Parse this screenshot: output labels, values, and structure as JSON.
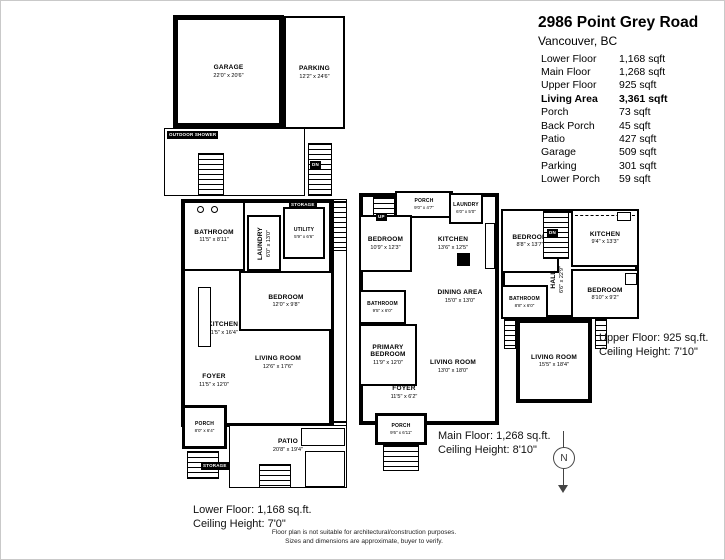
{
  "header": {
    "title": "2986 Point Grey Road",
    "subtitle": "Vancouver, BC"
  },
  "area_table": {
    "rows": [
      {
        "label": "Lower Floor",
        "value": "1,168 sqft"
      },
      {
        "label": "Main Floor",
        "value": "1,268 sqft"
      },
      {
        "label": "Upper Floor",
        "value": "925 sqft"
      },
      {
        "label": "Living Area",
        "value": "3,361 sqft"
      },
      {
        "label": "Porch",
        "value": "73 sqft"
      },
      {
        "label": "Back Porch",
        "value": "45 sqft"
      },
      {
        "label": "Patio",
        "value": "427 sqft"
      },
      {
        "label": "Garage",
        "value": "509 sqft"
      },
      {
        "label": "Parking",
        "value": "301 sqft"
      },
      {
        "label": "Lower Porch",
        "value": "59 sqft"
      }
    ]
  },
  "plans": {
    "lower": {
      "caption": {
        "line1": "Lower Floor: 1,168 sq.ft.",
        "line2": "Ceiling Height: 7'0\""
      },
      "rooms": {
        "garage": {
          "name": "GARAGE",
          "dims": "22'0\" x 20'6\""
        },
        "parking": {
          "name": "PARKING",
          "dims": "12'2\" x 24'6\""
        },
        "outdoor_shower": {
          "name": "OUTDOOR SHOWER"
        },
        "bathroom": {
          "name": "BATHROOM",
          "dims": "11'5\" x 8'11\""
        },
        "laundry": {
          "name": "LAUNDRY",
          "dims": "6'0\" x 13'0\""
        },
        "utility": {
          "name": "UTILITY",
          "dims": "5'9\" x 6'6\""
        },
        "storage_top": {
          "name": "STORAGE"
        },
        "bedroom": {
          "name": "BEDROOM",
          "dims": "12'0\" x 9'8\""
        },
        "kitchen": {
          "name": "KITCHEN",
          "dims": "11'5\" x 16'4\""
        },
        "living_room": {
          "name": "LIVING ROOM",
          "dims": "12'6\" x 17'6\""
        },
        "foyer": {
          "name": "FOYER",
          "dims": "11'5\" x 12'0\""
        },
        "porch": {
          "name": "PORCH",
          "dims": "8'0\" x 6'4\""
        },
        "patio": {
          "name": "PATIO",
          "dims": "20'8\" x 19'4\""
        },
        "storage_bottom": {
          "name": "STORAGE"
        }
      }
    },
    "main": {
      "caption": {
        "line1": "Main Floor: 1,268 sq.ft.",
        "line2": "Ceiling Height: 8'10\""
      },
      "rooms": {
        "porch_top": {
          "name": "PORCH",
          "dims": "9'0\" x 4'7\""
        },
        "laundry": {
          "name": "LAUNDRY",
          "dims": "6'0\" x 5'0\""
        },
        "bedroom": {
          "name": "BEDROOM",
          "dims": "10'9\" x 12'3\""
        },
        "kitchen": {
          "name": "KITCHEN",
          "dims": "13'6\" x 12'5\""
        },
        "dining_area": {
          "name": "DINING AREA",
          "dims": "15'0\" x 13'0\""
        },
        "bathroom": {
          "name": "BATHROOM",
          "dims": "9'5\" x 6'0\""
        },
        "primary_bedroom": {
          "name": "PRIMARY BEDROOM",
          "dims": "11'9\" x 12'0\""
        },
        "living_room": {
          "name": "LIVING ROOM",
          "dims": "13'0\" x 18'0\""
        },
        "foyer": {
          "name": "FOYER",
          "dims": "11'5\" x 6'2\""
        },
        "porch_bottom": {
          "name": "PORCH",
          "dims": "9'6\" x 6'11\""
        }
      }
    },
    "upper": {
      "caption": {
        "line1": "Upper Floor: 925 sq.ft.",
        "line2": "Ceiling Height: 7'10\""
      },
      "rooms": {
        "bedroom_left": {
          "name": "BEDROOM",
          "dims": "8'8\" x 13'7\""
        },
        "kitchen": {
          "name": "KITCHEN",
          "dims": "9'4\" x 13'3\""
        },
        "hall": {
          "name": "HALL",
          "dims": "6'6\" x 22'9\""
        },
        "bedroom_right": {
          "name": "BEDROOM",
          "dims": "8'10\" x 9'2\""
        },
        "bathroom": {
          "name": "BATHROOM",
          "dims": "8'8\" x 6'0\""
        },
        "living_room": {
          "name": "LIVING ROOM",
          "dims": "15'5\" x 18'4\""
        }
      }
    }
  },
  "labels": {
    "up": "UP",
    "dn": "DN"
  },
  "compass": {
    "label": "N"
  },
  "disclaimer": {
    "line1": "Floor plan is not suitable for architectural/construction purposes.",
    "line2": "Sizes and dimensions are approximate, buyer to verify."
  },
  "colors": {
    "wall": "#000000",
    "background": "#ffffff",
    "muted": "#444444"
  }
}
